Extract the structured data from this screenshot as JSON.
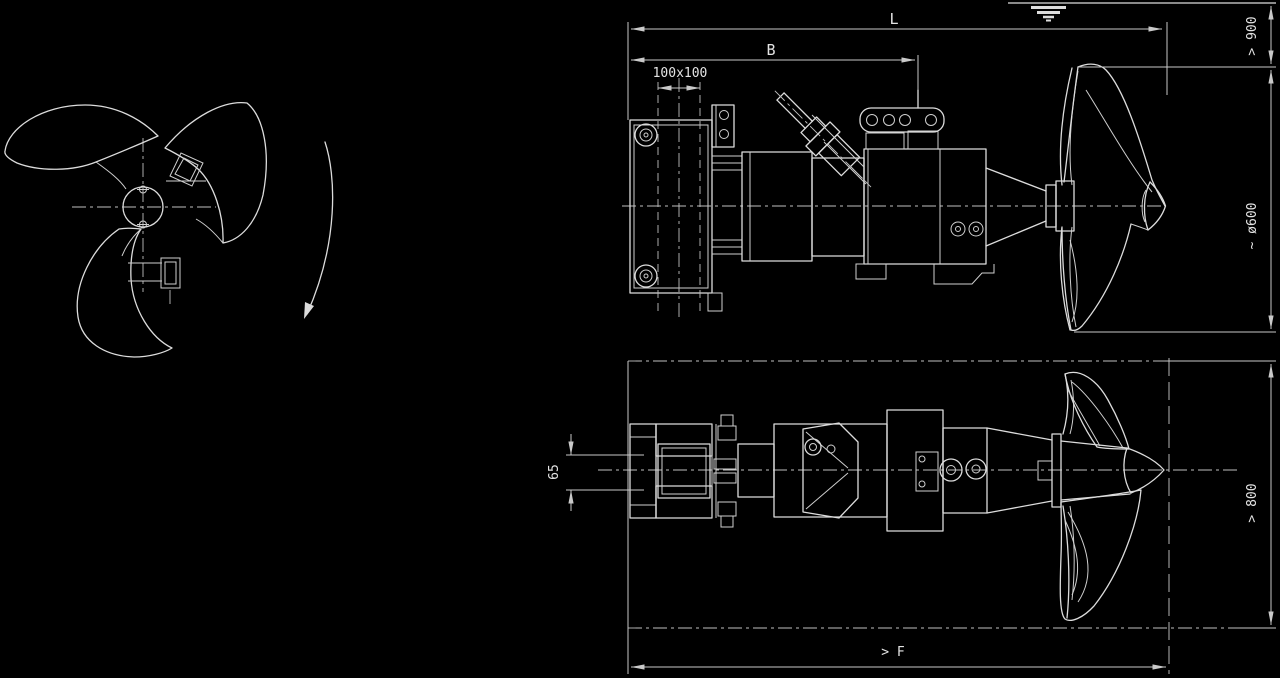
{
  "drawing": {
    "background": "#000000",
    "line_color": "#dcdcdc",
    "dim_color": "#c9c9c9",
    "labels": {
      "length": "L",
      "bracket": "B",
      "mast_profile": "100x100",
      "min_submergence": "> 900",
      "propeller_diameter": "~ ø600",
      "bottom_clearance": "> 800",
      "guide_width": "65",
      "min_free_distance": "> F"
    }
  }
}
